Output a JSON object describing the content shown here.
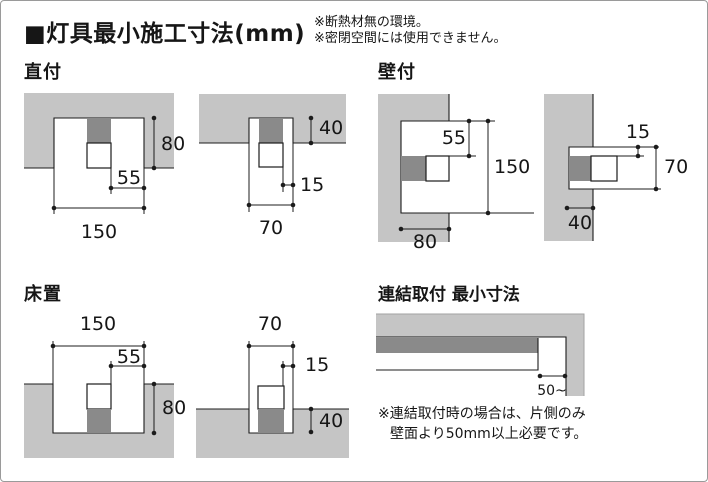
{
  "page": {
    "title": "■灯具最小施工寸法(mm)",
    "top_notes": [
      "※断熱材無の環境。",
      "※密閉空間には使用できません。"
    ]
  },
  "sections": {
    "direct_mount": {
      "label": "直付",
      "left": {
        "width": "150",
        "side_offset": "55",
        "height": "80"
      },
      "right": {
        "width": "70",
        "side_offset": "15",
        "height": "40"
      }
    },
    "wall_mount": {
      "label": "壁付",
      "left": {
        "top_offset": "55",
        "height": "150",
        "depth": "80"
      },
      "right": {
        "top_offset": "15",
        "height": "70",
        "depth": "40"
      }
    },
    "floor_mount": {
      "label": "床置",
      "left": {
        "width": "150",
        "side_offset": "55",
        "height": "80"
      },
      "right": {
        "width": "70",
        "side_offset": "15",
        "height": "40"
      }
    },
    "linked_mount": {
      "label": "連結取付 最小寸法",
      "gap": "50~",
      "notes": [
        "※連結取付時の場合は、片側のみ",
        "壁面より50mm以上必要です。"
      ]
    }
  },
  "colors": {
    "structure_gray": "#c5c5c5",
    "fixture_gray": "#8a8a8a",
    "line_black": "#1c1c1c"
  }
}
